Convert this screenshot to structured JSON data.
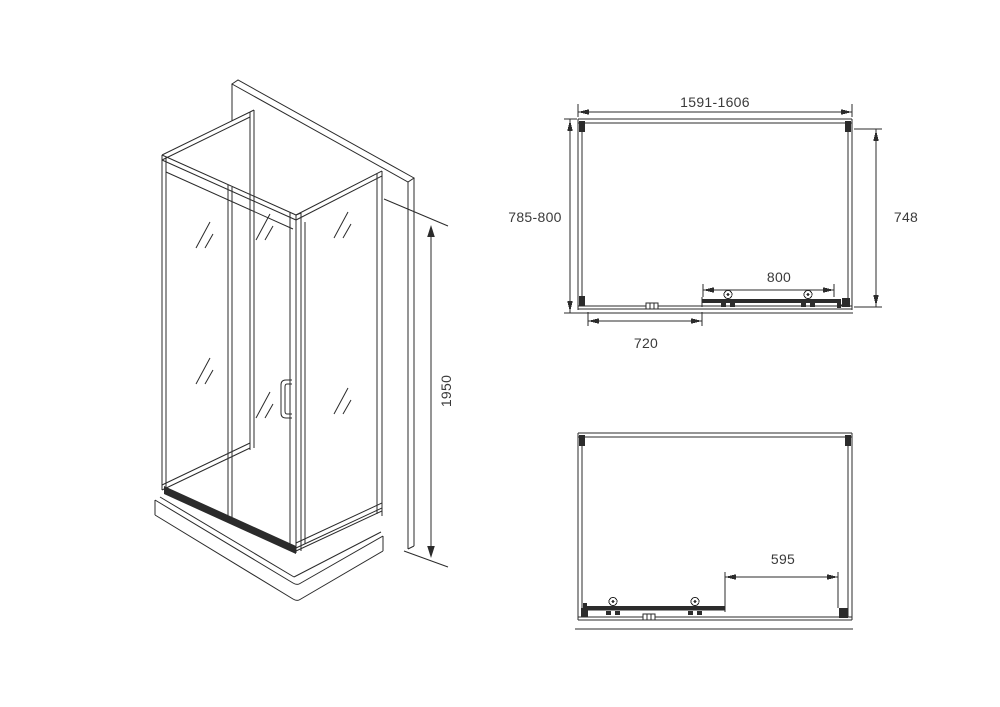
{
  "drawing": {
    "title": "corner shower enclosure technical drawing",
    "colors": {
      "line": "#2b2b2b",
      "label": "#3a3a3a",
      "background": "#ffffff"
    },
    "isometric": {
      "height": "1950"
    },
    "plan_top": {
      "width": "1591-1606",
      "depth_outer": "785-800",
      "depth_inner": "748",
      "door_width": "800",
      "fixed_width": "720"
    },
    "plan_bottom": {
      "opening": "595"
    }
  }
}
